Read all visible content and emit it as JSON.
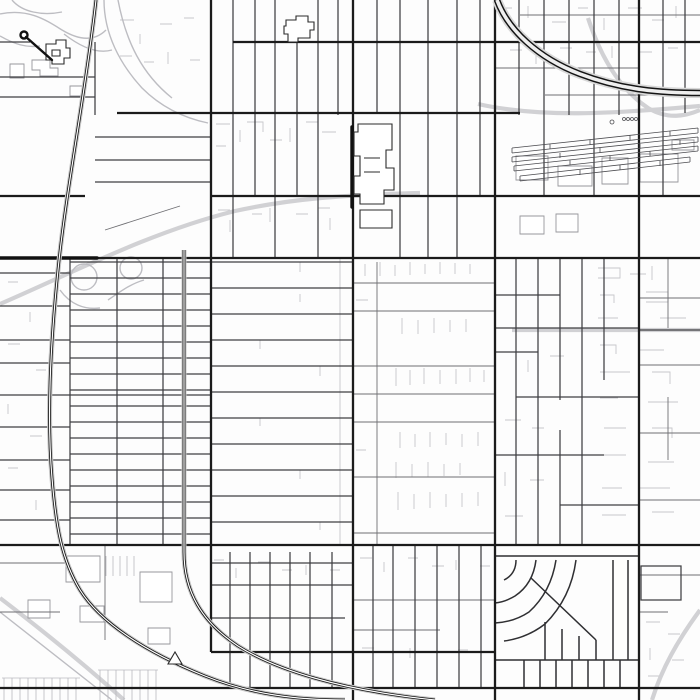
{
  "map": {
    "background": "#fdfdfd",
    "width": 700,
    "height": 700,
    "colors": {
      "major_road": "#1b1b1b",
      "secondary_road": "#3f3f42",
      "tertiary_road": "#6f6f73",
      "detail_line": "#c7c7cb",
      "gray_road": "#d1d1d4",
      "gray_road_thin": "#bdbdc2",
      "building_outline": "#97979c",
      "dark_building_outline": "#2b2b2b",
      "railway": "#101010",
      "railway_casing": "#c6c6c6",
      "highway": "#141414",
      "highway_casing": "#d8d8d8",
      "highway_core": "#eeeeee",
      "yard_line": "#4c4c50",
      "hatch_line": "#b9b9be"
    },
    "layers": [
      {
        "name": "detail-lines",
        "stroke": "#c7c7cb",
        "width": 0.9,
        "fill": "none",
        "paths": [
          "M598 268h22v10h-22M630 274h16M652 266v14M600 295h14v8M646 292h22v10h-22M598 318h20M660 318h26M600 345h16v9M640 350h24M600 372h30M652 372h18v12M600 398h18M648 402h30M604 428h22M652 428h20v10M600 455h26M648 462h26M602 488h20M640 488h30M602 515h24M652 512h22",
          "M365 264v12M380 262v14M395 265v11M410 262v13M425 264v10M440 262v12M455 263v11M470 264v10M402 318v16M418 320v14M434 318v15M450 320v12M466 319v13M396 368v18M410 370v15M424 368v16M440 370v14M456 369v15M470 368v14M484 370v12M400 432v16M415 434v13M430 432v15M446 433v12M462 434v13M478 432v14M396 462v16M412 464v13M428 462v15M444 464v12M460 463v12M398 492v18M414 494v15M430 492v16M446 494v13M462 493v14M478 492v14M356 300h12M356 450h10",
          "M340 258V545M300 262v10M300 294v8M260 340v9M320 366v10M260 418v8M300 470v9M320 522v8",
          "M216 124h14M216 146h10M240 130v12M247 122h16v10M270 140h12M290 128v14M306 122h12M322 132h14M218 210h12M230 220v12M252 214h10M270 208v14M296 214h12M318 208h12M330 218v12",
          "M500 8h12M528 6v12M552 22h14M578 8h10M604 18v12M628 8h14M652 20h12M676 6v12M510 50h12M536 54v10M560 48h12M586 52h10M612 46v12M640 52h12M668 48h10",
          "M214 560h10M236 568v10M258 562h12M282 570h10M306 565v10M330 570h10M360 558h12M384 562v10M408 558h10M432 566h12M456 560v10M480 566h10M362 648h12M386 652h10M410 648v10M434 652h12M458 650h10",
          "M646 622h14M668 634h12M650 648v12M672 660h12M648 676h14",
          "M8 282h10M30 312v10M8 344h12M36 370h10M8 404v10M30 436h12M8 468h10M36 500v10",
          "M120 20h14M140 34v10M160 24h12M184 18h10M120 56h12M144 62h10M168 52v12M190 60h10",
          "M505 352h18M528 360v12M550 356h14M505 420h16M532 428h12M505 472v14M530 480h14M505 516h18"
        ]
      },
      {
        "name": "gray-roads-wide",
        "stroke": "#d1d1d4",
        "width": 4.2,
        "fill": "none",
        "paths": [
          "M0 304C70 274 150 232 235 211C290 199 340 195 420 193",
          "M588 18C600 55 618 88 648 108C668 120 686 116 700 110",
          "M512 330H700",
          "M700 610C678 640 662 668 652 700",
          "M0 598C42 630 84 664 124 700",
          "M478 104C540 118 610 114 700 106"
        ]
      },
      {
        "name": "gray-roads-thin",
        "stroke": "#bdbdc2",
        "width": 1.4,
        "fill": "none",
        "paths": [
          "M60 290C70 304 84 310 100 308",
          "M108 300C120 292 130 284 144 280",
          "M0 612C38 642 76 672 112 700",
          "M0 14C28 8 46 20 62 30C82 42 96 40 106 30",
          "M12 0C22 12 42 16 62 12",
          "M64 34C82 48 98 54 112 50",
          "M0 36C14 44 26 48 40 46",
          "M104 0C104 34 120 64 142 88C162 108 184 118 208 123",
          "M118 0C126 42 142 74 172 98"
        ],
        "circles": [
          [
            84,
            277,
            13
          ],
          [
            131,
            268,
            11
          ]
        ]
      },
      {
        "name": "parking-hatches",
        "stroke": "#b9b9be",
        "width": 0.8,
        "fill": "none",
        "paths": [
          "M2 678H80M4 678V700M12 678V700M20 678V700M28 678V700M36 678V700M44 678V700M52 678V700M60 678V700M68 678V700M76 678V700",
          "M98 670H158M100 670V700M108 670V700M116 670V700M124 670V700M132 670V700M140 670V700M148 670V700M156 670V700",
          "M106 556V576M113 556V576M120 556V576M127 556V576M134 556V576"
        ]
      },
      {
        "name": "building-outlines",
        "stroke": "#97979c",
        "width": 0.9,
        "fill": "#ffffff",
        "paths": [
          "M516 156H548V180H516Z",
          "M558 166H592V186H558Z",
          "M602 158H628V184H602Z",
          "M640 154H678V182H640Z",
          "M520 216H544V234H520Z",
          "M556 214H578V232H556Z",
          "M672 140H694V150H672Z",
          "M66 556H100V582H66Z",
          "M140 572H172V602H140Z",
          "M28 600H50V618H28Z",
          "M80 606H104V622H80Z",
          "M148 628H170V644H148Z",
          "M32 60H50V68H58V76H40V70H32Z",
          "M10 64H24V78H10Z",
          "M70 86H84V96H70Z"
        ]
      },
      {
        "name": "tertiary-roads",
        "stroke": "#6f6f73",
        "width": 0.9,
        "fill": "none",
        "paths": [
          "M520 15H700",
          "M495 68H640",
          "M545 95H700",
          "M353 283H495",
          "M353 311H495",
          "M353 366H495",
          "M353 394H495",
          "M353 422H495",
          "M353 477H495",
          "M353 533H495",
          "M377 262V545",
          "M639 298H700",
          "M639 365H700",
          "M639 433H700",
          "M639 500H700",
          "M668 258V328",
          "M668 397V460",
          "M353 600H495",
          "M353 630H440",
          "M639 575H700",
          "M639 612H668",
          "M105 230L180 206",
          "M105 546V640",
          "M0 612H60",
          "M0 563H66"
        ]
      },
      {
        "name": "secondary-roads",
        "stroke": "#3f3f42",
        "width": 1.25,
        "fill": "none",
        "paths": [
          "M0 77H95",
          "M0 97H95",
          "M95 137H211",
          "M95 160H211",
          "M95 182H211",
          "M95 42V115",
          "M0 42H30",
          "M233 0V258",
          "M255 0V196",
          "M275 0V258",
          "M297 42V196",
          "M318 0V258",
          "M338 0V115",
          "M400 0V258",
          "M428 0V258",
          "M457 0V258",
          "M480 0V196",
          "M377 0V113",
          "M519 0V115",
          "M544 0V196",
          "M569 0V115",
          "M594 0V196",
          "M619 0V115",
          "M663 0V196",
          "M685 0V113",
          "M70 258V545",
          "M117 258V545",
          "M163 258V545",
          "M70 262H211",
          "M70 278H211",
          "M70 294H211",
          "M70 310H211",
          "M70 326H211",
          "M70 342H211",
          "M70 358H211",
          "M70 374H211",
          "M70 390H211",
          "M70 406H211",
          "M70 422H211",
          "M70 438H211",
          "M70 454H211",
          "M70 470H211",
          "M70 486H211",
          "M70 502H211",
          "M70 518H211",
          "M70 534H211",
          "M0 395H211",
          "M0 273H70",
          "M0 306H70",
          "M0 340H70",
          "M0 363H70",
          "M0 427H70",
          "M0 460H70",
          "M0 490H70",
          "M0 520H70",
          "M211 262H353",
          "M211 288H353",
          "M211 314H353",
          "M211 340H353",
          "M211 366H353",
          "M211 392H353",
          "M211 418H353",
          "M211 444H353",
          "M211 470H353",
          "M211 496H353",
          "M211 522H353",
          "M516 258V545",
          "M538 258V545",
          "M560 258V400",
          "M560 430V545",
          "M582 258V545",
          "M604 258V380",
          "M495 295H560",
          "M495 328H639",
          "M495 352H538",
          "M516 397H639",
          "M495 455H604",
          "M560 505H639",
          "M639 330H700",
          "M230 552V688",
          "M250 552V688",
          "M270 552V688",
          "M290 552V688",
          "M310 552V688",
          "M332 552V688",
          "M211 563H353",
          "M211 585H353",
          "M211 618H345",
          "M373 545V688",
          "M393 545V688",
          "M415 545V688",
          "M437 545V688",
          "M459 545V688",
          "M481 545V688",
          "M641 566H681V600H641Z"
        ]
      },
      {
        "name": "subdivision-streets",
        "stroke": "#2f2f32",
        "width": 1.5,
        "fill": "none",
        "paths": [
          "M495 556H639",
          "M516 560Q516 574 504 580",
          "M536 560Q533 584 515 596Q505 602 495 603",
          "M556 560Q551 592 529 612Q514 622 495 623",
          "M576 560Q571 598 545 624Q527 638 504 641",
          "M531 578L596 640",
          "M613 560V660",
          "M628 560V660",
          "M596 640V660",
          "M579 636V660",
          "M562 629V660",
          "M545 622V660",
          "M495 660H639",
          "M524 660V688",
          "M540 660V688",
          "M556 660V688",
          "M572 660V688",
          "M588 660V688",
          "M604 660V688",
          "M620 660V688"
        ]
      },
      {
        "name": "major-roads",
        "stroke": "#1b1b1b",
        "width": 2.3,
        "fill": "none",
        "paths": [
          "M211 0V652",
          "M353 0V700",
          "M495 0V700",
          "M639 0V700",
          "M0 258H700",
          "M0 545H700",
          "M211 652H495",
          "M0 688H700",
          "M233 42H700",
          "M117 113H520",
          "M0 196H85",
          "M211 196H700"
        ]
      },
      {
        "name": "major-road-bold-segments",
        "stroke": "#111111",
        "width": 3.4,
        "fill": "none",
        "linecap": "round",
        "paths": [
          "M0 258H97",
          "M352 127V207"
        ]
      },
      {
        "name": "railway-casing",
        "stroke": "#c6c6c6",
        "width": 5,
        "fill": "none",
        "paths": [
          "M96 0C86 90 66 190 58 270C50 348 47 420 52 478C56 528 62 560 80 590C100 622 145 652 205 676C250 694 295 700 345 700",
          "M184 250V552C184 592 202 622 238 646C276 670 340 690 435 700"
        ]
      },
      {
        "name": "railway-line",
        "stroke": "#101010",
        "width": 2.8,
        "fill": "none",
        "paths": [
          "M96 0C86 90 66 190 58 270C50 348 47 420 52 478C56 528 62 560 80 590C100 622 145 652 205 676C250 694 295 700 345 700",
          "M184 250V552C184 592 202 622 238 646C276 670 340 690 435 700"
        ]
      },
      {
        "name": "railway-core",
        "stroke": "#fdfdfd",
        "width": 1.2,
        "fill": "none",
        "paths": [
          "M96 0C86 90 66 190 58 270C50 348 47 420 52 478C56 528 62 560 80 590C100 622 145 652 205 676C250 694 295 700 345 700",
          "M184 250V552C184 592 202 622 238 646C276 670 340 690 435 700"
        ]
      },
      {
        "name": "highway-casing",
        "stroke": "#d8d8d8",
        "width": 10,
        "fill": "none",
        "paths": [
          "M497 0C508 30 538 58 580 74C622 90 662 93 700 93"
        ]
      },
      {
        "name": "highway-line",
        "stroke": "#141414",
        "width": 6.5,
        "fill": "none",
        "paths": [
          "M497 0C508 30 538 58 580 74C622 90 662 93 700 93"
        ]
      },
      {
        "name": "highway-core",
        "stroke": "#eeeeee",
        "width": 3.6,
        "fill": "none",
        "paths": [
          "M497 0C508 30 538 58 580 74C622 90 662 93 700 93"
        ]
      },
      {
        "name": "rail-yard-strips",
        "stroke": "#4c4c50",
        "width": 0.8,
        "fill": "none",
        "paths": [
          "M512 148L698 128M512 153L698 133M512 148V153M698 128V133M550 144V149M590 140V145M630 135V140M670 131V136",
          "M512 157L698 137M512 162L698 142M512 157V162M698 137V142M560 153V158M600 148V153M640 144V149M680 140V145",
          "M514 166L698 146M514 171L698 151M514 166V171M698 146V151M570 160V165M610 156V161M650 151V156",
          "M520 176L690 157M520 181L690 162M520 176V181M690 157V162M580 170V175M620 165V170M660 161V166"
        ],
        "circles": [
          [
            612,
            122,
            2
          ],
          [
            624,
            119,
            1.5
          ],
          [
            628,
            119,
            1.5
          ],
          [
            632,
            119,
            1.5
          ],
          [
            636,
            119,
            1.5
          ]
        ]
      },
      {
        "name": "dark-buildings",
        "stroke": "#2b2b2b",
        "width": 1.1,
        "fill": "#ffffff",
        "paths": [
          "M286 20H296V16H308V22H314V30H310V38H298V42H288V34H284V26H286Z",
          "M358 124H392V150H386V168H394V190H384V204H360V194H354V176H360V156H354V132H358Z",
          "M364 158H380M364 172H380",
          "M360 210H392V228H360Z",
          "M46 44H56V40H66V48H70V58H64V64H52V60H46Z",
          "M52 50H60V56H52Z",
          "M168 664H182L175 652Z"
        ]
      },
      {
        "name": "poi-connector",
        "stroke": "#111111",
        "width": 2.4,
        "fill": "none",
        "linecap": "round",
        "paths": [
          "M26 37L52 60"
        ],
        "circles": [
          [
            24,
            35,
            3.5
          ]
        ]
      }
    ]
  }
}
